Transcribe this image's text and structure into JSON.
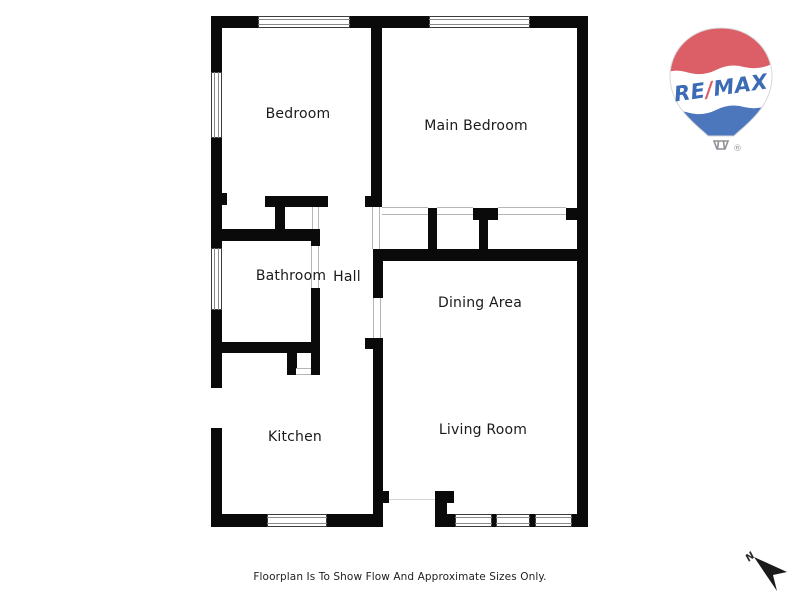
{
  "colors": {
    "wall": "#0a0a0a",
    "window-line": "#8a8a8a",
    "opening-line": "#b5b5b5",
    "label": "#1a1a1a",
    "remax-red": "#dc5e66",
    "remax-blue": "#4c77bc",
    "remax-text": "#3a6bb4",
    "basket-gray": "#8d9196"
  },
  "rooms": {
    "bedroom": "Bedroom",
    "main_bedroom": "Main Bedroom",
    "bathroom": "Bathroom",
    "hall": "Hall",
    "dining_area": "Dining Area",
    "kitchen": "Kitchen",
    "living_room": "Living Room"
  },
  "logo": {
    "re": "RE",
    "slash": "/",
    "max": "MAX",
    "registered": "®"
  },
  "compass": {
    "label": "N"
  },
  "footer": {
    "note": "Floorplan Is To Show Flow And Approximate Sizes Only."
  }
}
